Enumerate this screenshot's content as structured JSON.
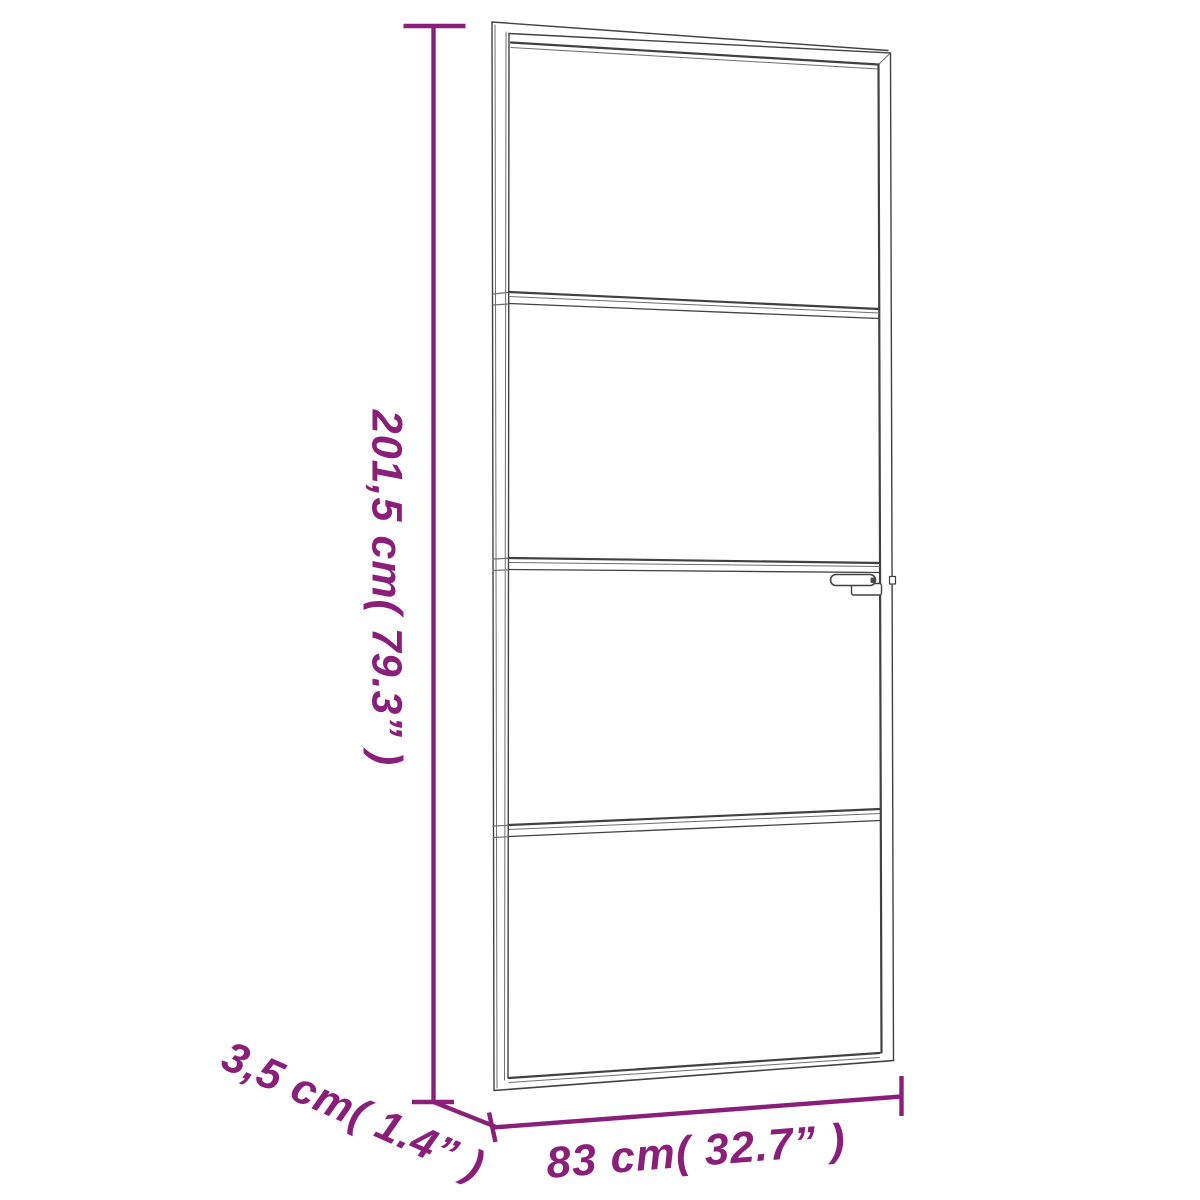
{
  "figure": {
    "colors": {
      "accent": "#8A1F7A",
      "line": "#414141",
      "line_light": "#6E6E6E",
      "background": "#FFFFFF"
    },
    "labels": {
      "height": "201,5 cm( 79.3” )",
      "depth": "3,5 cm( 1.4” )",
      "width": "83 cm( 32.7” )"
    }
  }
}
